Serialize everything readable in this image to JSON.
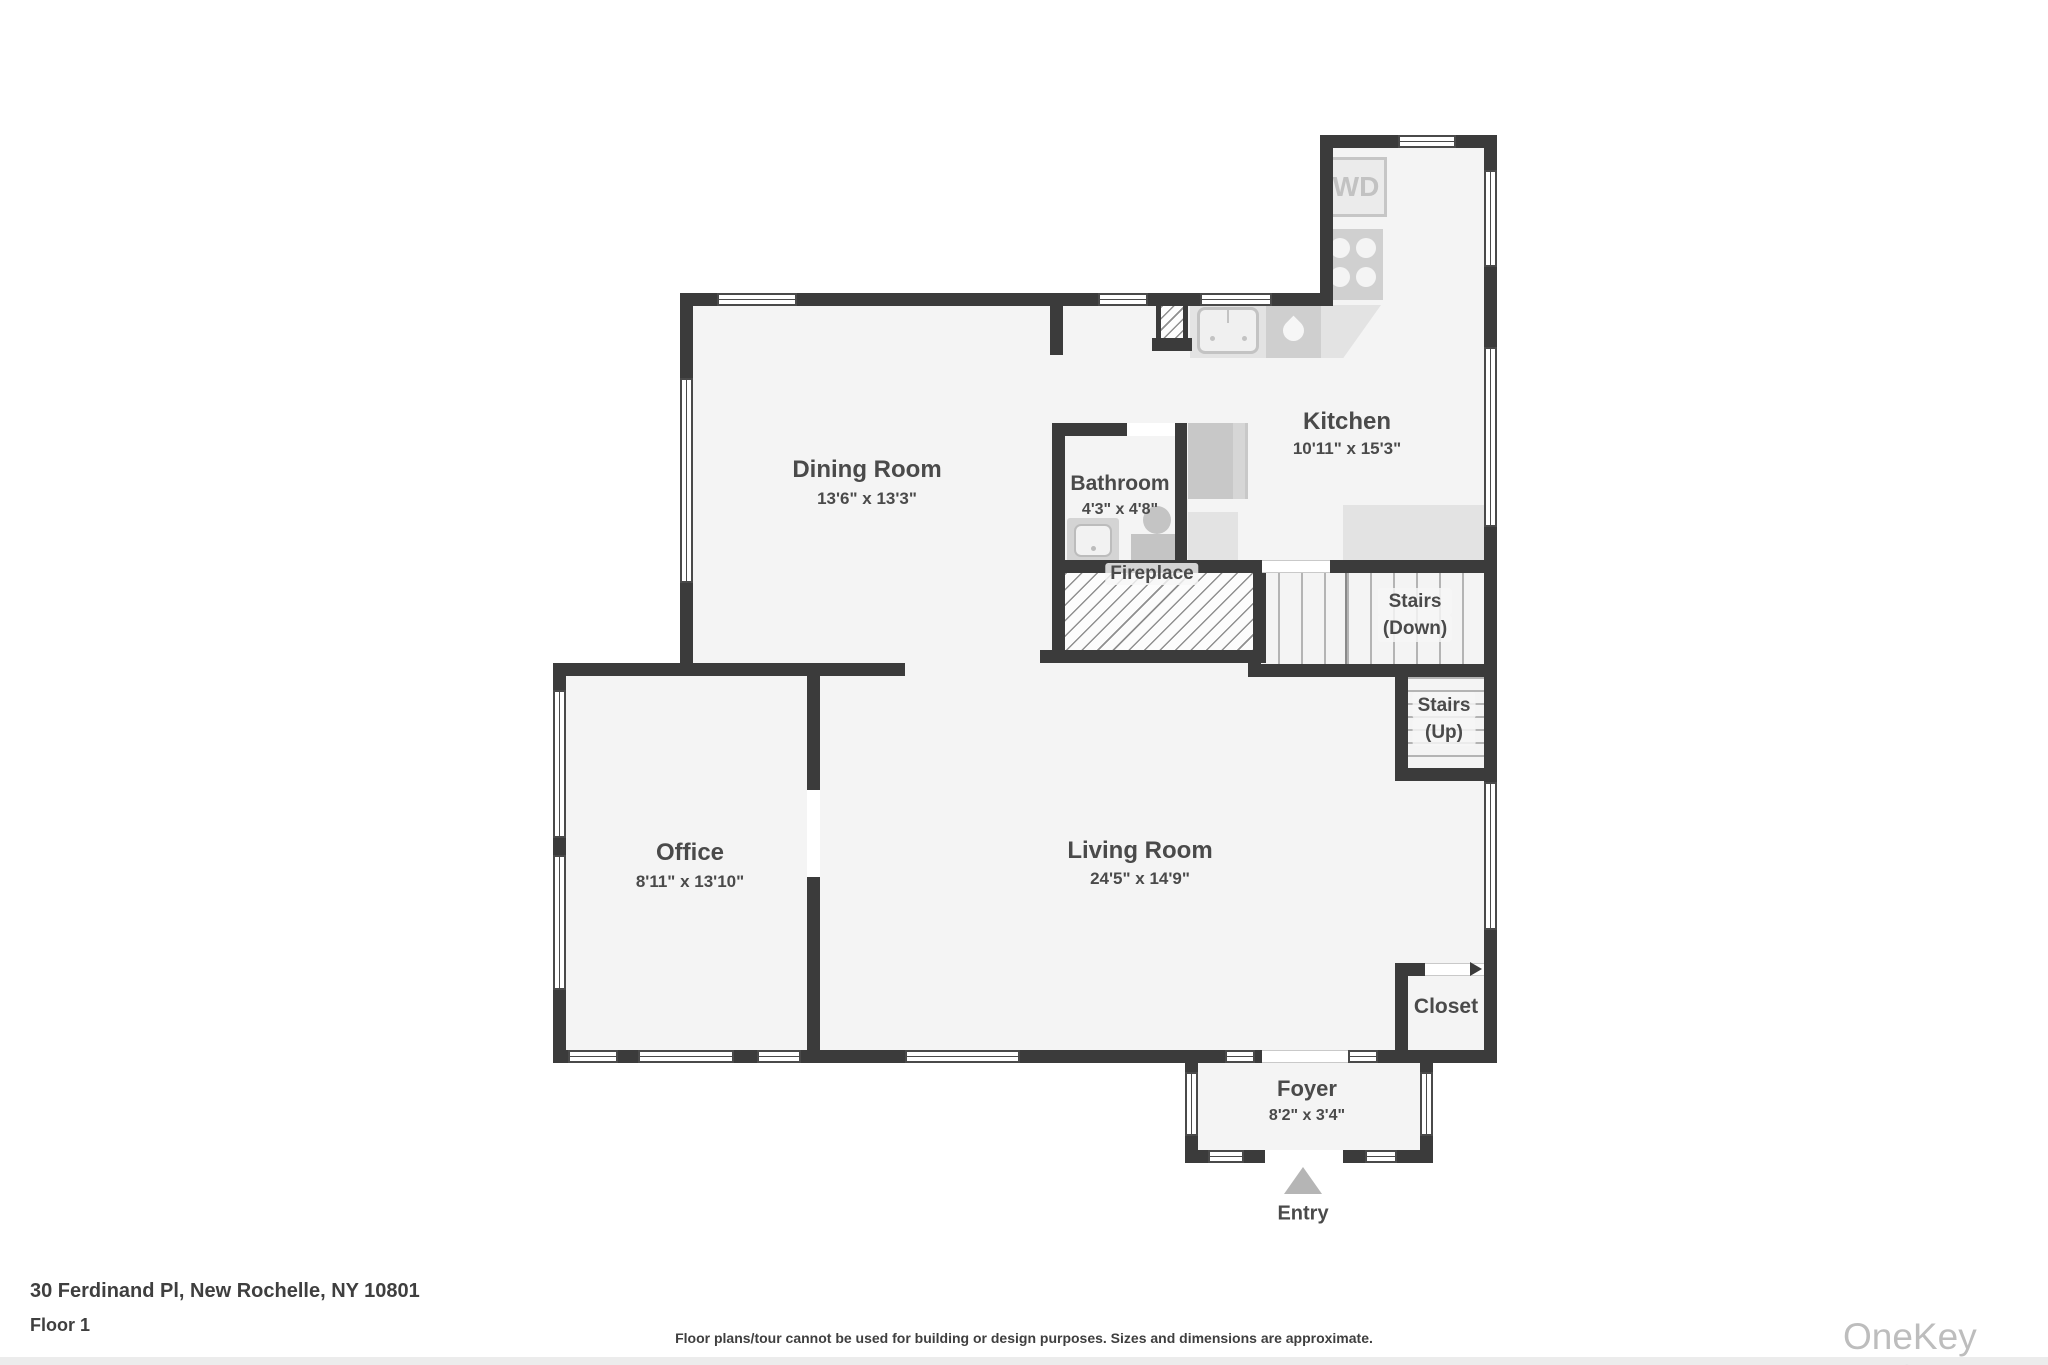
{
  "plan": {
    "rooms": {
      "dining": {
        "name": "Dining Room",
        "dims": "13'6\" x 13'3\""
      },
      "kitchen": {
        "name": "Kitchen",
        "dims": "10'11\" x 15'3\""
      },
      "bathroom": {
        "name": "Bathroom",
        "dims": "4'3\" x 4'8\""
      },
      "office": {
        "name": "Office",
        "dims": "8'11\" x 13'10\""
      },
      "living": {
        "name": "Living Room",
        "dims": "24'5\" x 14'9\""
      },
      "foyer": {
        "name": "Foyer",
        "dims": "8'2\" x 3'4\""
      },
      "closet": {
        "name": "Closet"
      },
      "fireplace": {
        "name": "Fireplace"
      },
      "stairs_down": {
        "line1": "Stairs",
        "line2": "(Down)"
      },
      "stairs_up": {
        "line1": "Stairs",
        "line2": "(Up)"
      },
      "entry": {
        "name": "Entry"
      }
    },
    "appliances": {
      "washer_dryer": "WD"
    },
    "icons": [
      "washer-dryer",
      "stove-burners",
      "kitchen-sink",
      "dishwasher-droplet",
      "refrigerator",
      "bathroom-sink",
      "toilet",
      "entry-arrow",
      "closet-door-arrow",
      "chimney"
    ],
    "colors": {
      "wall": "#3b3b3b",
      "floor": "#f4f4f4",
      "fixture": "#cfcfcf",
      "counter": "#e3e3e3",
      "label": "#4a4a4a",
      "watermark": "#bdbdbd"
    }
  },
  "footer": {
    "address": "30 Ferdinand Pl, New Rochelle, NY 10801",
    "floor_label": "Floor 1",
    "disclaimer": "Floor plans/tour cannot be used for building or design purposes. Sizes and dimensions are approximate.",
    "watermark": "OneKey MLS"
  }
}
